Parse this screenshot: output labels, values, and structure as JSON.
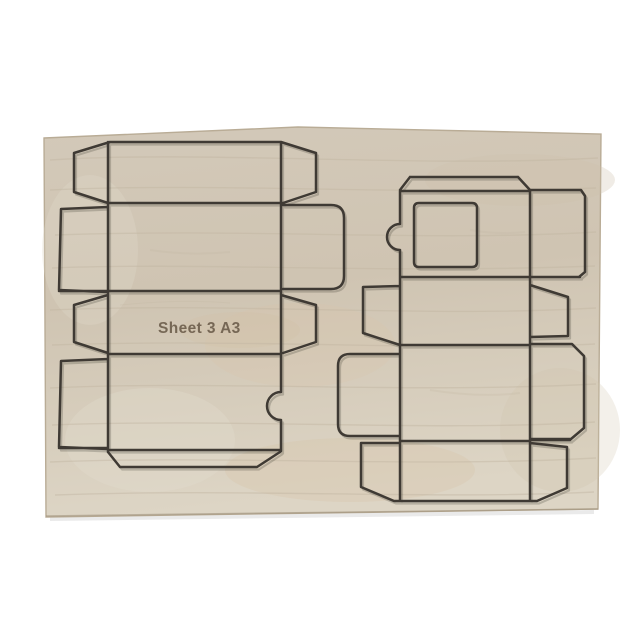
{
  "scene": {
    "type": "product-photo",
    "subject": "plywood die-cutting board with two steel-rule box-blank dies",
    "background_color": "#ffffff",
    "board": {
      "label": "Sheet 3 A3",
      "label_color": "#6a5b49",
      "wood_base_color": "#d2c8b7",
      "wood_light_color": "#e0d8c9",
      "wood_stain_color": "#d7c2a7",
      "edge_color": "#b9ac96",
      "rule_color": "#3f3a34",
      "rule_shadow_color": "#2b2722"
    },
    "dies": {
      "left": "vertical box blank: chamfered wing flaps, large side flaps, rounded tuck flap on right, semicircular thumb notch, chamfered bottom flap",
      "right": "vertical box blank: trapezoid top flap, square window cut-out, semicircular tab on left edge, chamfered side flaps, rounded tuck flap on left, chamfered bottom wings"
    }
  }
}
